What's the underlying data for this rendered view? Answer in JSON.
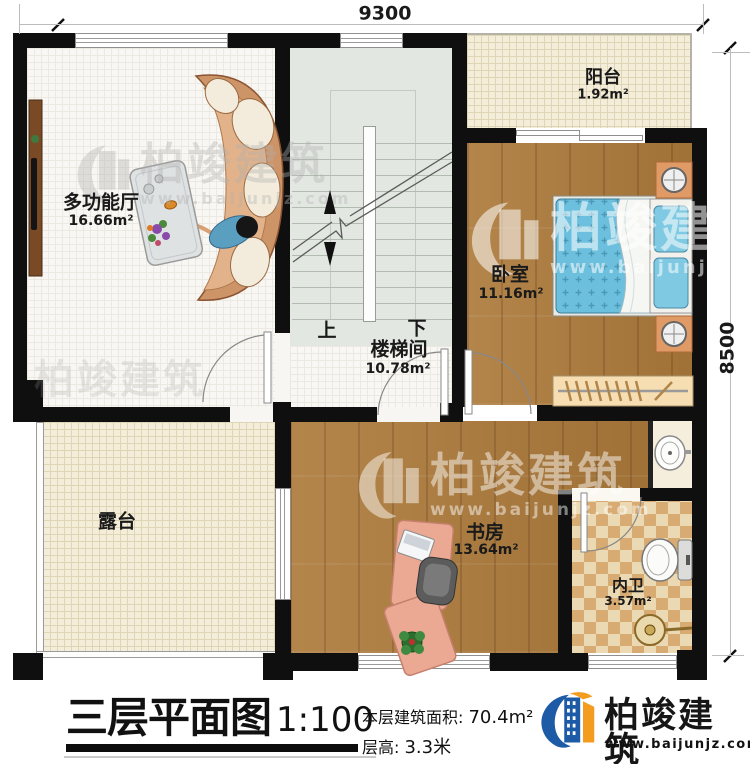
{
  "dimensions": {
    "top": "9300",
    "right": "8500"
  },
  "rooms": {
    "hall": {
      "name": "多功能厅",
      "area": "16.66m²"
    },
    "balcony": {
      "name": "阳台",
      "area": "1.92m²"
    },
    "bedroom": {
      "name": "卧室",
      "area": "11.16m²"
    },
    "stairwell": {
      "name": "楼梯间",
      "area": "10.78m²",
      "up": "上",
      "down": "下"
    },
    "terrace": {
      "name": "露台"
    },
    "study": {
      "name": "书房",
      "area": "13.64m²"
    },
    "bathroom": {
      "name": "内卫",
      "area": "3.57m²"
    }
  },
  "title_block": {
    "title": "三层平面图",
    "scale": "1:100",
    "floor_area_label": "本层建筑面积: ",
    "floor_area_value": "70.4m²",
    "floor_height_label": "层高: ",
    "floor_height_value": "3.3米"
  },
  "brand": {
    "name": "柏竣建筑",
    "website": "www.baijunjz.com"
  },
  "watermark": {
    "text": "柏竣建筑",
    "url": "www.baijunjz.com"
  },
  "colors": {
    "wall": "#0f0f0f",
    "wood": "#ad7b3c",
    "accent_blue": "#1d5ba6",
    "accent_orange": "#f49c1f",
    "bed_blue": "#6dc0dd"
  }
}
